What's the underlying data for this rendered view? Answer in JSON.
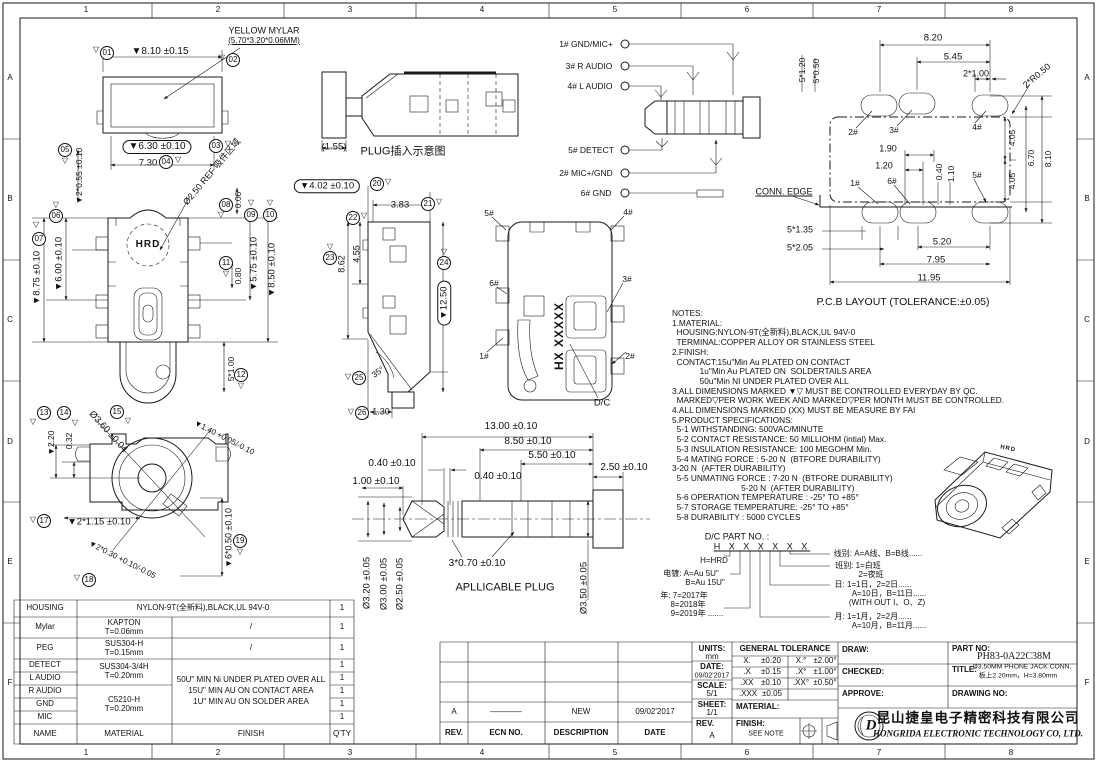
{
  "document_type": "engineering-drawing",
  "part_no": "PH83-0A22C38M",
  "titleblock": {
    "units_label": "UNITS:",
    "units": "mm",
    "date_label": "DATE:",
    "date": "09/02'2017",
    "scale_label": "SCALE:",
    "scale": "5/1",
    "sheet_label": "SHEET:",
    "sheet": "1/1",
    "rev_label": "REV.",
    "rev": "A",
    "material_label": "MATERIAL:",
    "finish_label": "FINISH:",
    "finish": "SEE NOTE",
    "draw_label": "DRAW:",
    "checked_label": "CHECKED:",
    "approve_label": "APPROVE:",
    "partno_label": "PART NO:",
    "partno": "PH83-0A22C38M",
    "title_label": "TITLE:",
    "title_line1": "Ø3.50MM PHONE JACK CONN,",
    "title_line2": "板上2.20mm，H=3.80mm",
    "drawingno_label": "DRAWING NO:",
    "company_cn": "昆山捷皇电子精密科技有限公司",
    "company_en": "HONGRIDA ELECTRONIC TECHNOLOGY CO, LTD.",
    "logo_letter": "D",
    "tol_header": "GENERAL TOLERANCE",
    "tol_linear": [
      [
        "X.",
        "±0.20"
      ],
      [
        ".X",
        "±0.15"
      ],
      [
        ".XX",
        "±0.10"
      ],
      [
        ".XXX",
        "±0.05"
      ]
    ],
    "tol_angular": [
      [
        "X.°",
        "±2.00°"
      ],
      [
        ".X°",
        "±1.00°"
      ],
      [
        ".XX°",
        "±0.50°"
      ]
    ]
  },
  "revisions": {
    "headers": {
      "rev": "REV.",
      "ecn": "ECN NO.",
      "description": "DESCRIPTION",
      "date": "DATE"
    },
    "entry": {
      "rev": "A",
      "ecn": "————",
      "description": "NEW",
      "date": "09/02'2017"
    }
  },
  "bom": {
    "rows": {
      "housing": {
        "name": "HOUSING",
        "material": "NYLON-9T(全新料),BLACK,UL 94V-0",
        "qty": "1"
      },
      "mylar": {
        "name": "Mylar",
        "material": "KAPTON",
        "spec": "T=0.06mm",
        "finish": "/",
        "qty": "1"
      },
      "peg": {
        "name": "PEG",
        "material": "SUS304-H",
        "spec": "T=0.15mm",
        "finish": "/",
        "qty": "1"
      },
      "detect": {
        "name": "DETECT",
        "qty": "1"
      },
      "laudio": {
        "name": "L AUDIO",
        "qty": "1"
      },
      "raudio": {
        "name": "R AUDIO",
        "qty": "1"
      },
      "gnd": {
        "name": "GND",
        "qty": "1"
      },
      "mic": {
        "name": "MIC",
        "qty": "1"
      }
    },
    "detect_material": "SUS304-3/4H",
    "detect_spec": "T=0.20mm",
    "metal_material": "C5210-H",
    "metal_spec": "T=0.20mm",
    "finish_lines": [
      "50U\" MIN Ni UNDER PLATED OVER ALL",
      "15U\" MIN AU ON CONTACT AREA",
      "1U\" MIN AU ON SOLDER AREA"
    ],
    "footer": {
      "name": "NAME",
      "material": "MATERIAL",
      "finish": "FINISH",
      "qty": "Q'TY"
    }
  },
  "notes": {
    "lines": [
      "NOTES:",
      "1.MATERIAL:",
      "  HOUSING:NYLON-9T(全新料),BLACK,UL 94V-0",
      "  TERMINAL:COPPER ALLOY OR STAINLESS STEEL",
      "2.FINISH:",
      "  CONTACT:15u\"Min Au PLATED ON CONTACT",
      "            1u\"Min Au PLATED ON  SOLDERTAILS AREA",
      "            50u\"Min NI UNDER PLATED OVER ALL",
      "3.ALL DIMENSIONS MARKED ▼▽ MUST BE CONTROLLED EVERYDAY BY QC.",
      "  MARKED▽PER WORK WEEK AND MARKED▽PER MONTH MUST BE CONTROLLED.",
      "4.ALL DIMENSIONS MARKED (XX) MUST BE MEASURE BY FAI",
      "5.PRODUCT SPECIFICATIONS:",
      "  5-1 WITHSTANDING: 500VAC/MINUTE",
      "  5-2 CONTACT RESISTANCE: 50 MILLIOHM (intial) Max.",
      "  5-3 INSULATION RESISTANCE: 100 MEGOHM Min.",
      "  5-4 MATING FORCE : 5-20 N  (BTFORE DURABILITY)",
      "3-20 N  (AFTER DURABILITY)",
      "  5-5 UNMATING FORCE : 7-20 N  (BTFORE DURABILITY)",
      "                              5-20 N  (AFTER DURABILITY)",
      "  5-6 OPERATION TEMPERATURE : -25° TO +85°",
      "  5-7 STORAGE TEMPERATURE: -25° TO +85°",
      "  5-8 DURABILITY : 5000 CYCLES"
    ]
  },
  "labels": [
    {
      "t": "1",
      "x": 86,
      "y": 10,
      "n": "grid-ref"
    },
    {
      "t": "2",
      "x": 218,
      "y": 10,
      "n": "grid-ref"
    },
    {
      "t": "3",
      "x": 350,
      "y": 10,
      "n": "grid-ref"
    },
    {
      "t": "4",
      "x": 482,
      "y": 10,
      "n": "grid-ref"
    },
    {
      "t": "5",
      "x": 615,
      "y": 10,
      "n": "grid-ref"
    },
    {
      "t": "6",
      "x": 747,
      "y": 10,
      "n": "grid-ref"
    },
    {
      "t": "7",
      "x": 879,
      "y": 10,
      "n": "grid-ref"
    },
    {
      "t": "8",
      "x": 1011,
      "y": 10,
      "n": "grid-ref"
    },
    {
      "t": "1",
      "x": 86,
      "y": 753,
      "n": "grid-ref"
    },
    {
      "t": "2",
      "x": 218,
      "y": 753,
      "n": "grid-ref"
    },
    {
      "t": "3",
      "x": 350,
      "y": 753,
      "n": "grid-ref"
    },
    {
      "t": "4",
      "x": 482,
      "y": 753,
      "n": "grid-ref"
    },
    {
      "t": "5",
      "x": 615,
      "y": 753,
      "n": "grid-ref"
    },
    {
      "t": "6",
      "x": 747,
      "y": 753,
      "n": "grid-ref"
    },
    {
      "t": "7",
      "x": 879,
      "y": 753,
      "n": "grid-ref"
    },
    {
      "t": "8",
      "x": 1011,
      "y": 753,
      "n": "grid-ref"
    },
    {
      "t": "A",
      "x": 10,
      "y": 78,
      "n": "grid-ref"
    },
    {
      "t": "B",
      "x": 10,
      "y": 199,
      "n": "grid-ref"
    },
    {
      "t": "C",
      "x": 10,
      "y": 320,
      "n": "grid-ref"
    },
    {
      "t": "D",
      "x": 10,
      "y": 442,
      "n": "grid-ref"
    },
    {
      "t": "E",
      "x": 10,
      "y": 562,
      "n": "grid-ref"
    },
    {
      "t": "F",
      "x": 10,
      "y": 683,
      "n": "grid-ref"
    },
    {
      "t": "A",
      "x": 1087,
      "y": 78,
      "n": "grid-ref"
    },
    {
      "t": "B",
      "x": 1087,
      "y": 199,
      "n": "grid-ref"
    },
    {
      "t": "C",
      "x": 1087,
      "y": 320,
      "n": "grid-ref"
    },
    {
      "t": "D",
      "x": 1087,
      "y": 442,
      "n": "grid-ref"
    },
    {
      "t": "E",
      "x": 1087,
      "y": 562,
      "n": "grid-ref"
    },
    {
      "t": "F",
      "x": 1087,
      "y": 683,
      "n": "grid-ref"
    },
    {
      "t": "YELLOW MYLAR",
      "x": 264,
      "y": 31,
      "s": 9,
      "n": "mylar-callout"
    },
    {
      "t": "(5.70*3.20*0.06MM)",
      "x": 264,
      "y": 41,
      "s": 8,
      "c": "u"
    },
    {
      "t": "▽",
      "x": 222,
      "y": 58,
      "s": 8
    },
    {
      "t": "02",
      "x": 233,
      "y": 60,
      "c": "bal"
    },
    {
      "t": "▽",
      "x": 96,
      "y": 50,
      "s": 8
    },
    {
      "t": "01",
      "x": 107,
      "y": 53,
      "c": "bal"
    },
    {
      "t": "▼8.10 ±0.15",
      "x": 160,
      "y": 52,
      "s": 10
    },
    {
      "t": "▼6.30 ±0.10",
      "x": 157,
      "y": 147,
      "s": 10,
      "c": "cap"
    },
    {
      "t": "03",
      "x": 216,
      "y": 146,
      "c": "bal"
    },
    {
      "t": "▽",
      "x": 228,
      "y": 144,
      "s": 8
    },
    {
      "t": "7.30",
      "x": 148,
      "y": 163,
      "s": 9.5
    },
    {
      "t": "04",
      "x": 166,
      "y": 162,
      "c": "bal"
    },
    {
      "t": "▽",
      "x": 178,
      "y": 160,
      "s": 8
    },
    {
      "t": "05",
      "x": 65,
      "y": 150,
      "c": "bal"
    },
    {
      "t": "▽",
      "x": 65,
      "y": 161,
      "s": 8
    },
    {
      "t": "▼2*0.55 ±0.10",
      "x": 79,
      "y": 176,
      "r": -90,
      "s": 8.5
    },
    {
      "t": "▽",
      "x": 56,
      "y": 205,
      "s": 8
    },
    {
      "t": "06",
      "x": 56,
      "y": 216,
      "c": "bal"
    },
    {
      "t": "▽",
      "x": 36,
      "y": 225,
      "s": 8
    },
    {
      "t": "07",
      "x": 39,
      "y": 239,
      "c": "bal"
    },
    {
      "t": "Ø2.50 REF 吸件区域",
      "x": 212,
      "y": 172,
      "r": -50,
      "s": 9
    },
    {
      "t": "0.06",
      "x": 238,
      "y": 200,
      "r": -90,
      "s": 8.5
    },
    {
      "t": "08",
      "x": 226,
      "y": 205,
      "c": "bal"
    },
    {
      "t": "▽",
      "x": 221,
      "y": 215,
      "s": 8
    },
    {
      "t": "▽",
      "x": 251,
      "y": 203,
      "s": 8
    },
    {
      "t": "09",
      "x": 251,
      "y": 215,
      "c": "bal"
    },
    {
      "t": "▽",
      "x": 270,
      "y": 203,
      "s": 8
    },
    {
      "t": "10",
      "x": 270,
      "y": 215,
      "c": "bal"
    },
    {
      "t": "▼8.75 ±0.10",
      "x": 37,
      "y": 278,
      "r": -90,
      "s": 9.5
    },
    {
      "t": "▼6.00 ±0.10",
      "x": 59,
      "y": 264,
      "r": -90,
      "s": 9.5
    },
    {
      "t": "HRD",
      "x": 148,
      "y": 245,
      "s": 10,
      "c": "hrd",
      "n": "hrd-logo-text"
    },
    {
      "t": "11",
      "x": 226,
      "y": 263,
      "c": "bal"
    },
    {
      "t": "▽",
      "x": 226,
      "y": 274,
      "s": 8
    },
    {
      "t": "0.80",
      "x": 238,
      "y": 276,
      "r": -90,
      "s": 8.5
    },
    {
      "t": "▼5.75 ±0.10",
      "x": 254,
      "y": 264,
      "r": -90,
      "s": 9.5
    },
    {
      "t": "▼8.50 ±0.10",
      "x": 272,
      "y": 270,
      "r": -90,
      "s": 9.5
    },
    {
      "t": "5*1.00",
      "x": 231,
      "y": 369,
      "r": -90,
      "s": 8.5
    },
    {
      "t": "12",
      "x": 241,
      "y": 375,
      "c": "bal"
    },
    {
      "t": "▽",
      "x": 241,
      "y": 386,
      "s": 8
    },
    {
      "t": "13",
      "x": 44,
      "y": 413,
      "c": "bal"
    },
    {
      "t": "▽",
      "x": 33,
      "y": 422,
      "s": 8
    },
    {
      "t": "14",
      "x": 64,
      "y": 413,
      "c": "bal"
    },
    {
      "t": "▽",
      "x": 75,
      "y": 423,
      "s": 8
    },
    {
      "t": "▼2.20",
      "x": 51,
      "y": 443,
      "r": -90,
      "s": 8.5
    },
    {
      "t": "0.32",
      "x": 69,
      "y": 441,
      "r": -90,
      "s": 8.5
    },
    {
      "t": "Ø3.60 ±0.04",
      "x": 108,
      "y": 432,
      "r": 48,
      "s": 9.5
    },
    {
      "t": "15",
      "x": 117,
      "y": 412,
      "c": "bal"
    },
    {
      "t": "▽",
      "x": 128,
      "y": 421,
      "s": 8
    },
    {
      "t": "▼1.40 +0.05/-0.10",
      "x": 224,
      "y": 438,
      "r": 27,
      "s": 8
    },
    {
      "t": "▽",
      "x": 33,
      "y": 520,
      "s": 8
    },
    {
      "t": "17",
      "x": 44,
      "y": 521,
      "c": "bal"
    },
    {
      "t": "▼2*1.15 ±0.10",
      "x": 99,
      "y": 522,
      "s": 9.5
    },
    {
      "t": "▽",
      "x": 77,
      "y": 578,
      "s": 8
    },
    {
      "t": "18",
      "x": 89,
      "y": 580,
      "c": "bal"
    },
    {
      "t": "▼2*0.30 +0.10/-0.05",
      "x": 122,
      "y": 560,
      "r": 27,
      "s": 8
    },
    {
      "t": "▼6*0.50 ±0.10",
      "x": 229,
      "y": 538,
      "r": -90,
      "s": 9
    },
    {
      "t": "19",
      "x": 240,
      "y": 541,
      "c": "bal"
    },
    {
      "t": "▽",
      "x": 240,
      "y": 552,
      "s": 8
    },
    {
      "t": "▼4.02 ±0.10",
      "x": 327,
      "y": 186,
      "s": 9.5,
      "c": "cap"
    },
    {
      "t": "20",
      "x": 377,
      "y": 184,
      "c": "bal"
    },
    {
      "t": "▽",
      "x": 388,
      "y": 182,
      "s": 8
    },
    {
      "t": "3.83",
      "x": 400,
      "y": 205,
      "s": 9.5
    },
    {
      "t": "21",
      "x": 428,
      "y": 204,
      "c": "bal"
    },
    {
      "t": "▽",
      "x": 439,
      "y": 202,
      "s": 8
    },
    {
      "t": "22",
      "x": 353,
      "y": 218,
      "c": "bal"
    },
    {
      "t": "▽",
      "x": 364,
      "y": 216,
      "s": 8
    },
    {
      "t": "▽",
      "x": 330,
      "y": 247,
      "s": 8
    },
    {
      "t": "23",
      "x": 330,
      "y": 258,
      "c": "bal"
    },
    {
      "t": "8.62",
      "x": 342,
      "y": 264,
      "r": -90,
      "s": 9
    },
    {
      "t": "4.55",
      "x": 357,
      "y": 254,
      "r": -90,
      "s": 9
    },
    {
      "t": "▽",
      "x": 444,
      "y": 252,
      "s": 8
    },
    {
      "t": "24",
      "x": 444,
      "y": 263,
      "c": "bal"
    },
    {
      "t": "▼12.50",
      "x": 444,
      "y": 303,
      "r": -90,
      "s": 9.5,
      "c": "cap"
    },
    {
      "t": "35°",
      "x": 378,
      "y": 372,
      "r": -35,
      "s": 8.5
    },
    {
      "t": "▽",
      "x": 348,
      "y": 377,
      "s": 8
    },
    {
      "t": "25",
      "x": 359,
      "y": 378,
      "c": "bal"
    },
    {
      "t": "▽",
      "x": 351,
      "y": 412,
      "s": 8
    },
    {
      "t": "26",
      "x": 362,
      "y": 413,
      "c": "bal"
    },
    {
      "t": "1.30",
      "x": 381,
      "y": 412,
      "s": 9
    },
    {
      "t": "5#",
      "x": 489,
      "y": 213,
      "s": 8.5
    },
    {
      "t": "4#",
      "x": 628,
      "y": 212,
      "s": 8.5
    },
    {
      "t": "6#",
      "x": 494,
      "y": 283,
      "s": 8.5
    },
    {
      "t": "3#",
      "x": 627,
      "y": 279,
      "s": 8.5
    },
    {
      "t": "1#",
      "x": 484,
      "y": 356,
      "s": 8.5
    },
    {
      "t": "2#",
      "x": 630,
      "y": 356,
      "s": 8.5
    },
    {
      "t": "HX XXXXX",
      "x": 559,
      "y": 336,
      "r": -90,
      "s": 12,
      "c": "hrd",
      "n": "date-code-marking"
    },
    {
      "t": "D/C",
      "x": 602,
      "y": 403,
      "s": 9.5
    },
    {
      "t": "1# GND/MIC+",
      "x": 586,
      "y": 44,
      "s": 8.5,
      "n": "pin-label"
    },
    {
      "t": "3# R AUDIO",
      "x": 589,
      "y": 66,
      "s": 8.5,
      "n": "pin-label"
    },
    {
      "t": "4# L AUDIO",
      "x": 590,
      "y": 86,
      "s": 8.5,
      "n": "pin-label"
    },
    {
      "t": "5# DETECT",
      "x": 591,
      "y": 150,
      "s": 8.5,
      "n": "pin-label"
    },
    {
      "t": "2# MIC+/GND",
      "x": 586,
      "y": 173,
      "s": 8.5,
      "n": "pin-label"
    },
    {
      "t": "6# GND",
      "x": 596,
      "y": 193,
      "s": 8.5,
      "n": "pin-label"
    },
    {
      "t": "(1.55)",
      "x": 334,
      "y": 147,
      "s": 9.5
    },
    {
      "t": "PLUG插入示意图",
      "x": 403,
      "y": 152,
      "s": 11,
      "n": "view-title-plug-insert"
    },
    {
      "t": "8.20",
      "x": 933,
      "y": 38,
      "s": 9.5
    },
    {
      "t": "5.45",
      "x": 953,
      "y": 57,
      "s": 9.5
    },
    {
      "t": "2*1.00",
      "x": 976,
      "y": 74,
      "s": 9
    },
    {
      "t": "2*R0.50",
      "x": 1037,
      "y": 76,
      "r": -40,
      "s": 9
    },
    {
      "t": "5*1.20",
      "x": 802,
      "y": 70,
      "r": -90,
      "s": 8.5
    },
    {
      "t": "5*0.50",
      "x": 816,
      "y": 71,
      "r": -90,
      "s": 8.5
    },
    {
      "t": "2#",
      "x": 853,
      "y": 132,
      "s": 8.5
    },
    {
      "t": "3#",
      "x": 894,
      "y": 130,
      "s": 8.5
    },
    {
      "t": "4#",
      "x": 977,
      "y": 127,
      "s": 8.5
    },
    {
      "t": "1.90",
      "x": 888,
      "y": 149,
      "s": 9
    },
    {
      "t": "1.20",
      "x": 884,
      "y": 166,
      "s": 9
    },
    {
      "t": "0.40",
      "x": 939,
      "y": 172,
      "r": -90,
      "s": 8.5
    },
    {
      "t": "1.10",
      "x": 951,
      "y": 174,
      "r": -90,
      "s": 8.5
    },
    {
      "t": "5#",
      "x": 977,
      "y": 175,
      "s": 8.5
    },
    {
      "t": "4.05",
      "x": 1012,
      "y": 138,
      "r": -90,
      "s": 8.5
    },
    {
      "t": "6.70",
      "x": 1031,
      "y": 158,
      "r": -90,
      "s": 8.5
    },
    {
      "t": "8.10",
      "x": 1048,
      "y": 159,
      "r": -90,
      "s": 8.5
    },
    {
      "t": "4.05",
      "x": 1012,
      "y": 181,
      "r": -90,
      "s": 8.5
    },
    {
      "t": "1#",
      "x": 855,
      "y": 183,
      "s": 8.5
    },
    {
      "t": "6#",
      "x": 892,
      "y": 181,
      "s": 8.5
    },
    {
      "t": "CONN. EDGE",
      "x": 784,
      "y": 192,
      "s": 9,
      "c": "u",
      "n": "conn-edge-label"
    },
    {
      "t": "5*1.35",
      "x": 800,
      "y": 230,
      "s": 9
    },
    {
      "t": "5*2.05",
      "x": 800,
      "y": 248,
      "s": 9
    },
    {
      "t": "5.20",
      "x": 942,
      "y": 242,
      "s": 9.5
    },
    {
      "t": "7.95",
      "x": 936,
      "y": 260,
      "s": 9.5
    },
    {
      "t": "11.95",
      "x": 929,
      "y": 278,
      "s": 9.5
    },
    {
      "t": "P.C.B LAYOUT (TOLERANCE:±0.05)",
      "x": 903,
      "y": 302,
      "s": 10.5,
      "n": "view-title-pcb"
    },
    {
      "t": "13.00 ±0.10",
      "x": 511,
      "y": 427,
      "s": 10
    },
    {
      "t": "8.50 ±0.10",
      "x": 528,
      "y": 442,
      "s": 10
    },
    {
      "t": "5.50 ±0.10",
      "x": 552,
      "y": 456,
      "s": 10
    },
    {
      "t": "2.50 ±0.10",
      "x": 624,
      "y": 468,
      "s": 10
    },
    {
      "t": "0.40 ±0.10",
      "x": 392,
      "y": 464,
      "s": 10
    },
    {
      "t": "0.40 ±0.10",
      "x": 498,
      "y": 477,
      "s": 10
    },
    {
      "t": "1.00 ±0.10",
      "x": 376,
      "y": 482,
      "s": 10
    },
    {
      "t": "3*0.70 ±0.10",
      "x": 477,
      "y": 564,
      "s": 10
    },
    {
      "t": "APLLICABLE PLUG",
      "x": 505,
      "y": 588,
      "s": 11,
      "n": "view-title-applicable-plug"
    },
    {
      "t": "Ø3.20 ±0.05",
      "x": 367,
      "y": 583,
      "r": -90,
      "s": 9.5
    },
    {
      "t": "Ø3.00 ±0.05",
      "x": 384,
      "y": 584,
      "r": -90,
      "s": 9.5
    },
    {
      "t": "Ø2.50 ±0.05",
      "x": 400,
      "y": 584,
      "r": -90,
      "s": 9.5
    },
    {
      "t": "Ø3.50 ±0.05",
      "x": 584,
      "y": 588,
      "r": -90,
      "s": 9.5
    },
    {
      "t": "D/C PART NO. :",
      "x": 737,
      "y": 537,
      "s": 9,
      "n": "dc-part-no-label"
    },
    {
      "t": "H X X X X X X",
      "x": 762,
      "y": 547,
      "s": 9,
      "c": "hx",
      "n": "dc-part-no-code"
    },
    {
      "t": "H=HRD",
      "x": 714,
      "y": 561,
      "s": 8
    },
    {
      "t": "电镀: A=Au 5U\"",
      "x": 691,
      "y": 574,
      "s": 8
    },
    {
      "t": "B=Au 15U\"",
      "x": 705,
      "y": 583,
      "s": 8
    },
    {
      "t": "年: 7=2017年",
      "x": 684,
      "y": 596,
      "s": 8
    },
    {
      "t": "8=2018年",
      "x": 688,
      "y": 605,
      "s": 8
    },
    {
      "t": "9=2019年 .......",
      "x": 697,
      "y": 614,
      "s": 8
    },
    {
      "t": "线别: A=A线、B=B线......",
      "x": 878,
      "y": 554,
      "s": 8
    },
    {
      "t": "班别: 1=白班",
      "x": 858,
      "y": 566,
      "s": 8
    },
    {
      "t": "2=夜班",
      "x": 871,
      "y": 575,
      "s": 8
    },
    {
      "t": "日: 1=1日，2=2日......",
      "x": 873,
      "y": 585,
      "s": 8
    },
    {
      "t": "A=10日，B=11日......",
      "x": 889,
      "y": 594,
      "s": 8
    },
    {
      "t": "(WITH OUT I、O、Z)",
      "x": 887,
      "y": 603,
      "s": 8
    },
    {
      "t": "月: 1=1月，2=2月......",
      "x": 873,
      "y": 617,
      "s": 8
    },
    {
      "t": "A=10月，B=11月......",
      "x": 889,
      "y": 626,
      "s": 8
    },
    {
      "t": "HRD",
      "x": 1008,
      "y": 449,
      "r": 12,
      "s": 6,
      "c": "hrd",
      "n": "iso-hrd-text"
    }
  ]
}
